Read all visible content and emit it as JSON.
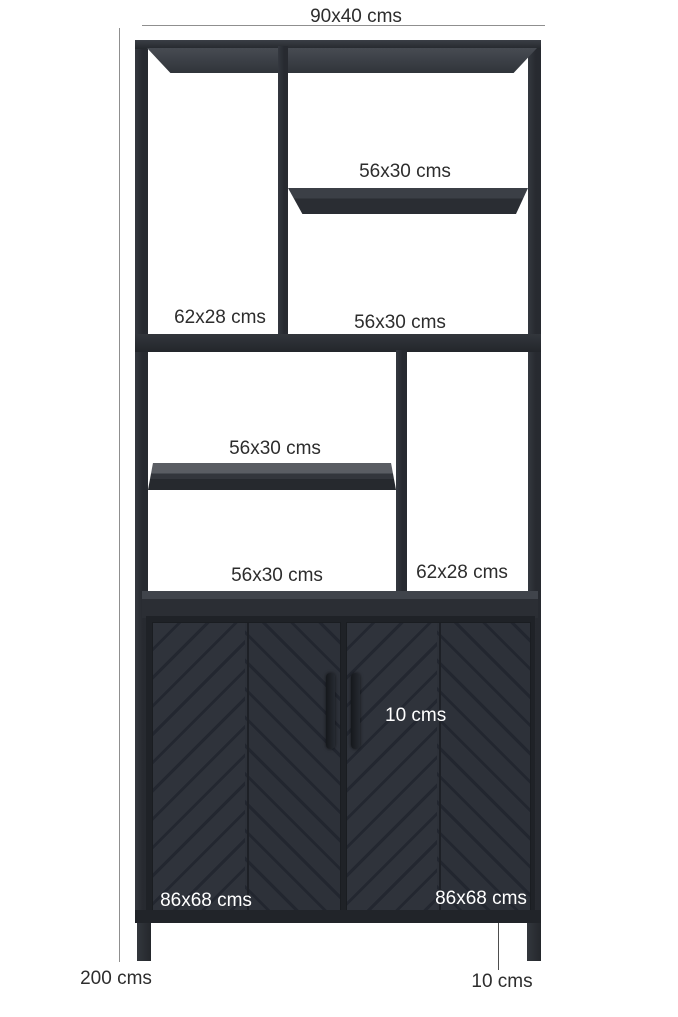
{
  "diagram": {
    "subject": "black metal and wood bookshelf cabinet with dimension annotations"
  },
  "dimensions": {
    "top": "90x40 cms",
    "shelf_top_right": "56x30 cms",
    "compartment_left_tall": "62x28 cms",
    "compartment_right_mid": "56x30 cms",
    "shelf_mid_left": "56x30 cms",
    "compartment_lower_left": "56x30 cms",
    "compartment_right_tall": "62x28 cms",
    "handle_length": "10 cms",
    "door_left": "86x68 cms",
    "door_right": "86x68 cms",
    "total_height": "200 cms",
    "leg_height": "10 cms"
  },
  "colors": {
    "background": "#ffffff",
    "frame": "#2b2e34",
    "door": "#2e323a",
    "label_text": "#2d2d2d",
    "label_text_on_dark": "#ffffff",
    "dimension_line": "#8f8f8f"
  }
}
